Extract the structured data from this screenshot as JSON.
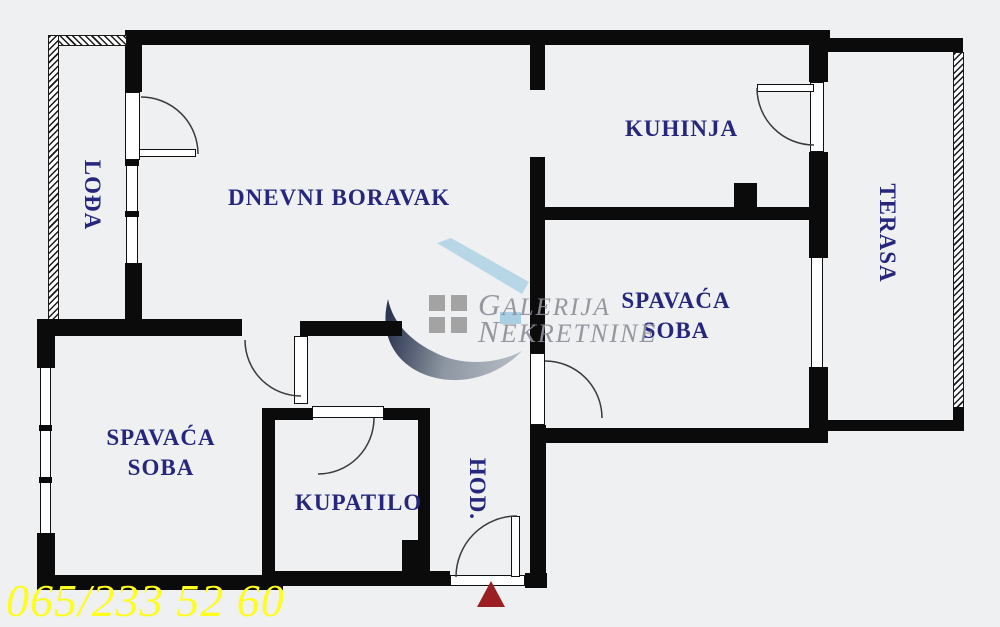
{
  "plan": {
    "type": "apartment-floor-plan",
    "rooms": {
      "loda": {
        "label": "LOĐA"
      },
      "dnevni_boravak": {
        "label": "DNEVNI BORAVAK"
      },
      "kuhinja": {
        "label": "KUHINJA"
      },
      "terasa": {
        "label": "TERASA"
      },
      "spavaca_soba_desno": {
        "line1": "SPAVAĆA",
        "line2": "SOBA"
      },
      "spavaca_soba_levo": {
        "line1": "SPAVAĆA",
        "line2": "SOBA"
      },
      "kupatilo": {
        "label": "KUPATILO"
      },
      "hodnik": {
        "label": "HOD."
      }
    },
    "entrance_marker": "entrance-arrow"
  },
  "watermark": {
    "line1": "GALERIJA",
    "line2": "NEKRETNINE"
  },
  "phone": "065/233 52 60",
  "colors": {
    "background": "#eef0f2",
    "wall": "#0b0b0b",
    "label_navy": "#26267d",
    "phone_yellow": "#fdfd1f",
    "arrow_red": "#9b1f22",
    "watermark_gray": "#8f8f97",
    "logo_blue": "#b7d7e6",
    "logo_square_gray": "#a3a3a3"
  }
}
